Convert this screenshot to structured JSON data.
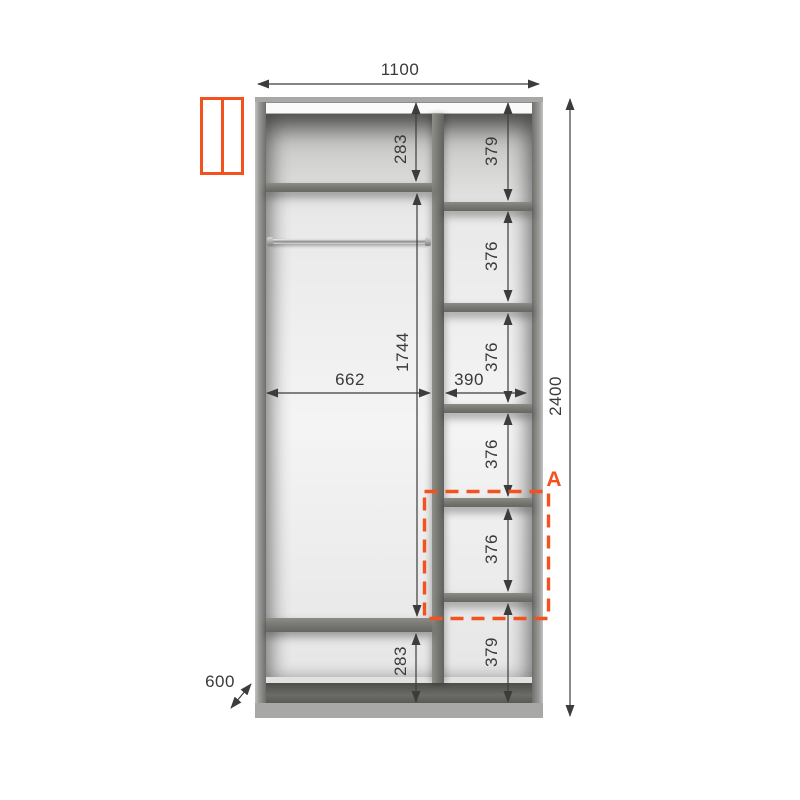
{
  "drawing": {
    "kind": "wardrobe-section-diagram",
    "colors": {
      "accent": "#f4511e",
      "line": "#3c3c3c",
      "carcass": "#a8a8a6",
      "shelf": "#76716f"
    },
    "dims": {
      "total_width": "1100",
      "total_height": "2400",
      "depth": "600",
      "left_top_gap": "283",
      "left_inner_height": "1744",
      "left_inner_width": "662",
      "left_bottom_gap": "283",
      "right_inner_width": "390",
      "right_cells": [
        "379",
        "376",
        "376",
        "376",
        "376",
        "379"
      ],
      "detail_label": "A"
    }
  }
}
